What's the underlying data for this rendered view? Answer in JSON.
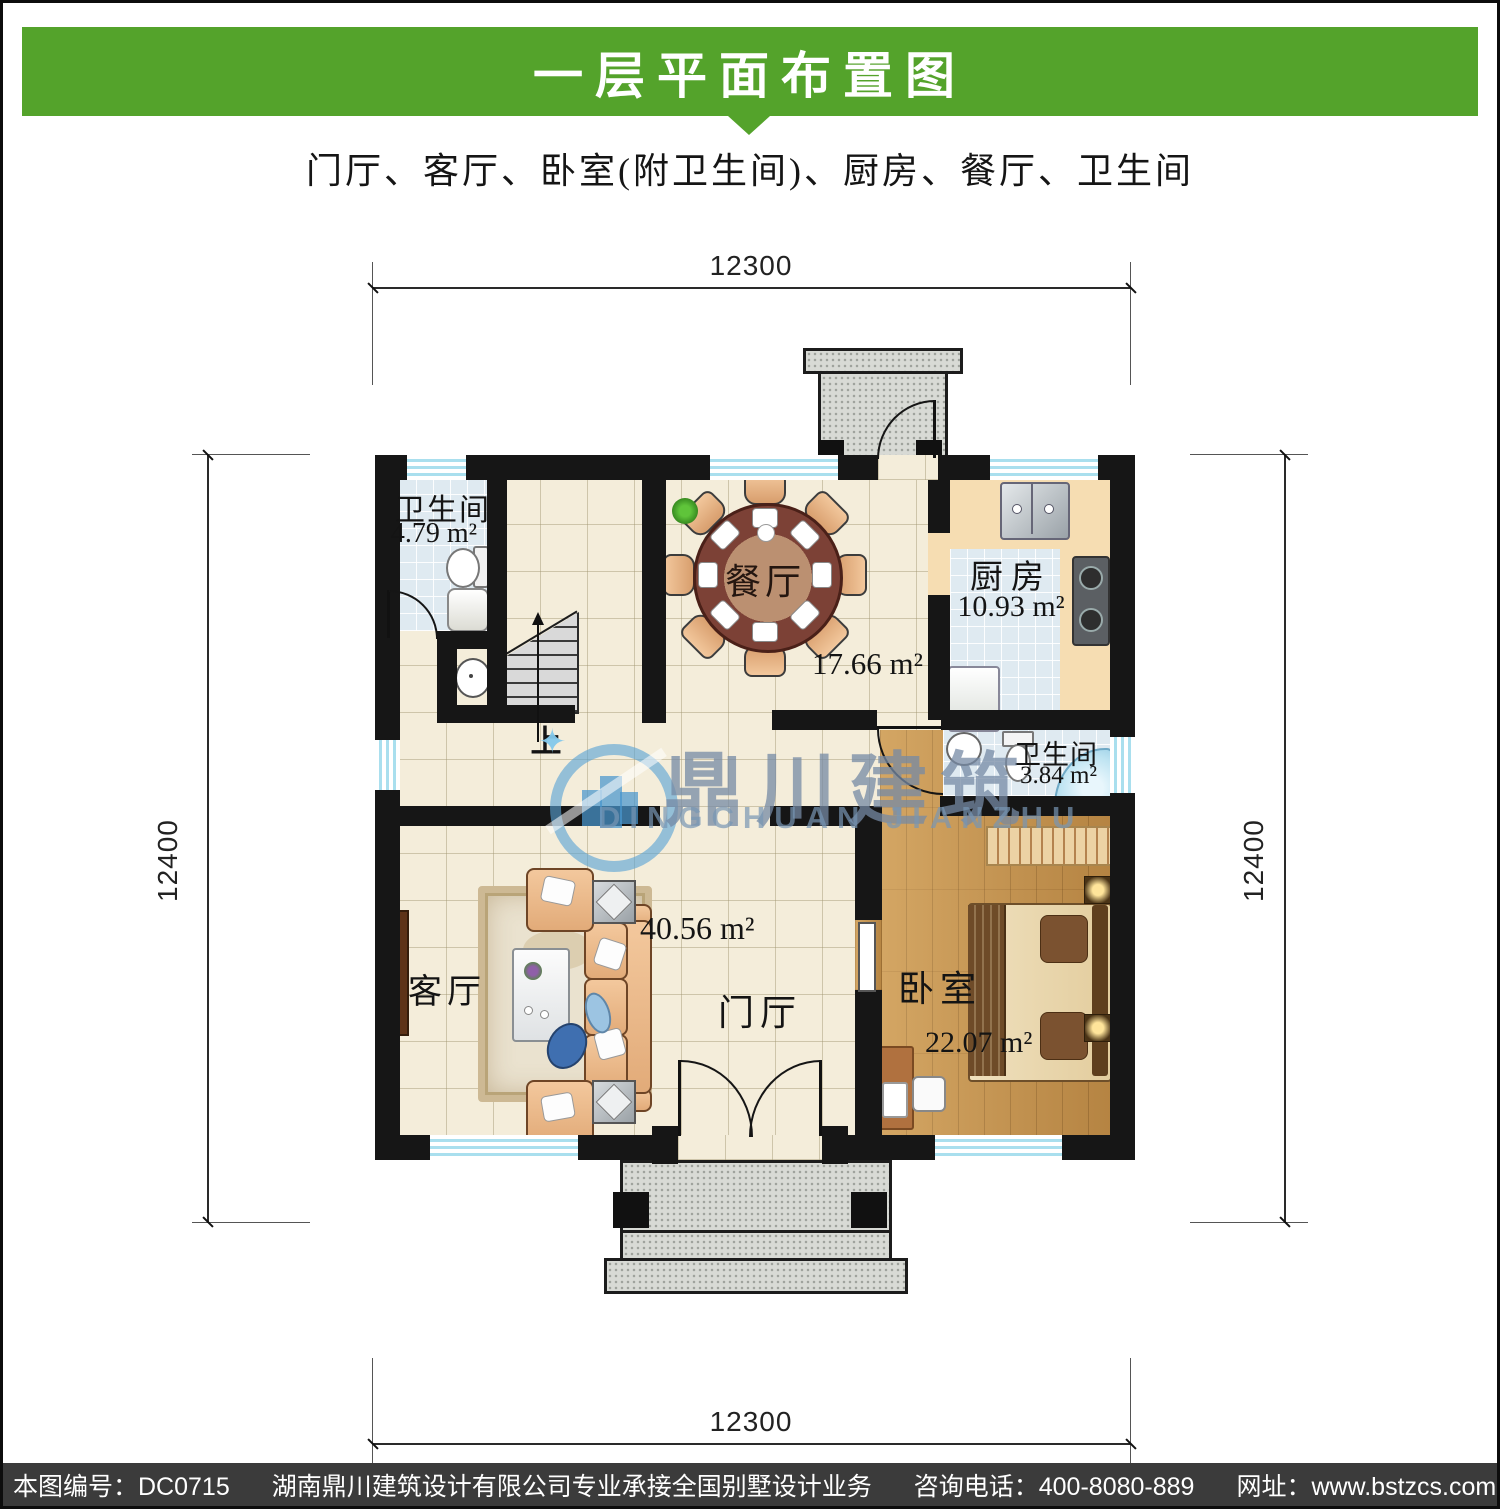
{
  "header": {
    "title": "一层平面布置图",
    "subtitle": "门厅、客厅、卧室(附卫生间)、厨房、餐厅、卫生间"
  },
  "colors": {
    "banner_green": "#54a32b",
    "footer_gray": "#3b3b3b",
    "wall_black": "#161616",
    "watermark_blue": "#4896cd"
  },
  "dimensions": {
    "top": "12300",
    "bottom": "12300",
    "left": "12400",
    "right": "12400"
  },
  "rooms": {
    "bath1": {
      "name": "卫生间",
      "area": "4.79 m²"
    },
    "dining": {
      "name": "餐厅",
      "area": "17.66 m²"
    },
    "kitchen": {
      "name": "厨房",
      "area": "10.93 m²"
    },
    "bath2": {
      "name": "卫生间",
      "area": "3.84 m²"
    },
    "living": {
      "name": "客厅"
    },
    "foyer": {
      "name": "门厅",
      "area": "40.56 m²"
    },
    "bedroom": {
      "name": "卧室",
      "area": "22.07 m²"
    },
    "stair_up": "上"
  },
  "watermark": {
    "cn": "鼎川建筑",
    "en": "DINGCHUAN JIANZHU"
  },
  "footer": {
    "plan_no": "本图编号：DC0715",
    "company": "湖南鼎川建筑设计有限公司专业承接全国别墅设计业务",
    "phone": "咨询电话：400-8080-889",
    "website": "网址：www.bstzcs.com"
  }
}
